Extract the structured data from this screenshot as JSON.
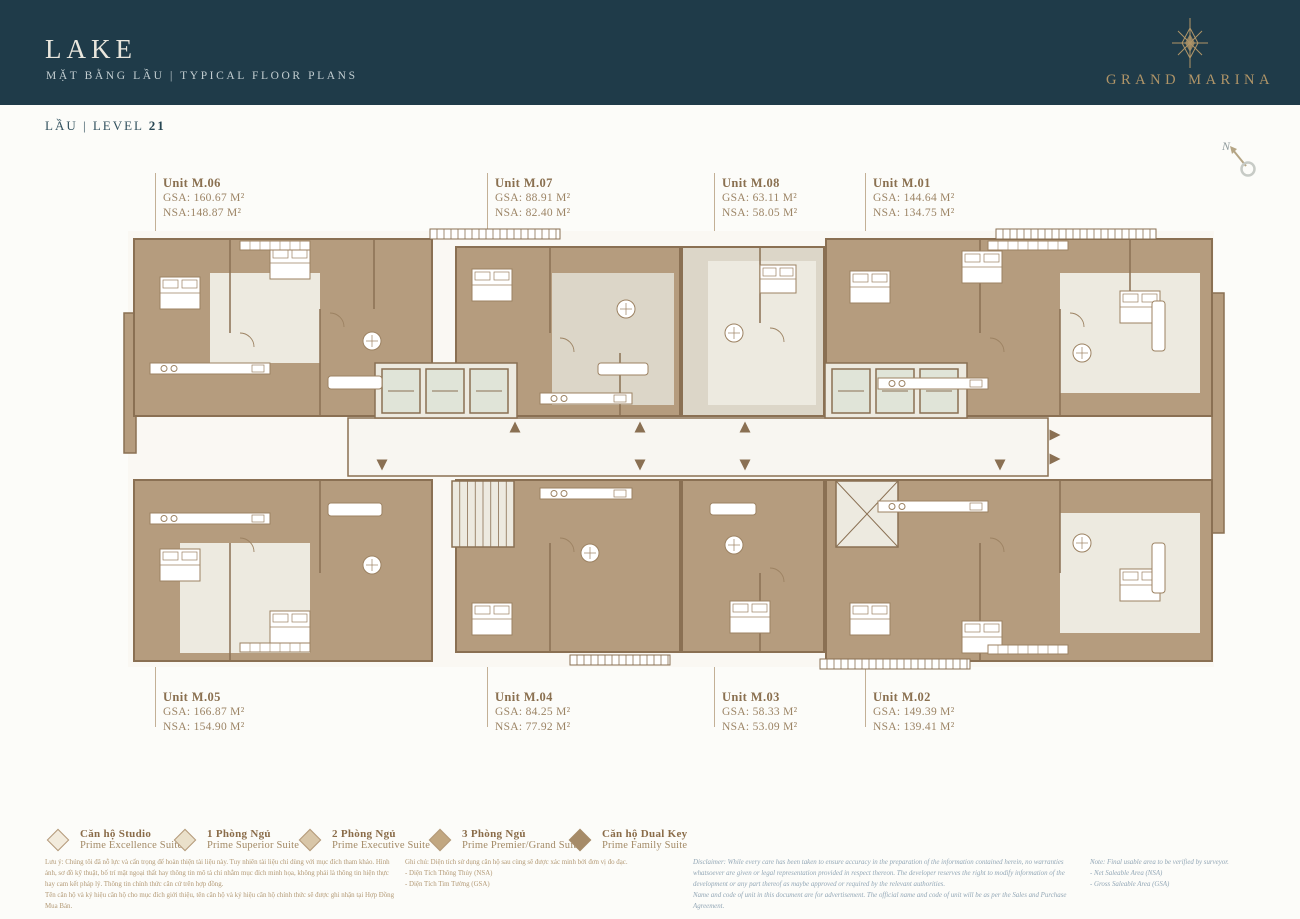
{
  "header": {
    "title": "LAKE",
    "subtitle": "MẶT BẰNG LẦU  |  TYPICAL FLOOR PLANS",
    "brand": "GRAND MARINA"
  },
  "level": {
    "label": "LẦU | LEVEL ",
    "number": "21"
  },
  "north_label": "N",
  "units": {
    "top": [
      {
        "name": "Unit M.06",
        "gsa": "GSA: 160.67 M²",
        "nsa": "NSA:148.87 M²"
      },
      {
        "name": "Unit M.07",
        "gsa": "GSA: 88.91 M²",
        "nsa": "NSA: 82.40 M²"
      },
      {
        "name": "Unit M.08",
        "gsa": "GSA: 63.11 M²",
        "nsa": "NSA: 58.05 M²"
      },
      {
        "name": "Unit M.01",
        "gsa": "GSA: 144.64 M²",
        "nsa": "NSA: 134.75 M²"
      }
    ],
    "bottom": [
      {
        "name": "Unit M.05",
        "gsa": "GSA: 166.87 M²",
        "nsa": "NSA: 154.90 M²"
      },
      {
        "name": "Unit M.04",
        "gsa": "GSA: 84.25 M²",
        "nsa": "NSA: 77.92 M²"
      },
      {
        "name": "Unit M.03",
        "gsa": "GSA: 58.33 M²",
        "nsa": "NSA: 53.09 M²"
      },
      {
        "name": "Unit M.02",
        "gsa": "GSA: 149.39 M²",
        "nsa": "NSA: 139.41 M²"
      }
    ]
  },
  "legend": [
    {
      "vi": "Căn hộ Studio",
      "en": "Prime Excellence Suite",
      "fill": "#f2ebdc",
      "border": "#b49a7a"
    },
    {
      "vi": "1 Phòng Ngủ",
      "en": "Prime Superior Suite",
      "fill": "#eae0ca",
      "border": "#b49a7a"
    },
    {
      "vi": "2 Phòng Ngủ",
      "en": "Prime Executive Suite",
      "fill": "#d8c6a8",
      "border": "#b49a7a"
    },
    {
      "vi": "3 Phòng Ngủ",
      "en": "Prime Premier/Grand Suite",
      "fill": "#c1a781",
      "border": "#b49a7a"
    },
    {
      "vi": "Căn hộ Dual Key",
      "en": "Prime Family Suite",
      "fill": "#a68b68",
      "border": "#a68b68"
    }
  ],
  "footnotes": {
    "vi_disclaimer": "Lưu ý: Chúng tôi đã nỗ lực và cẩn trọng để hoàn thiện tài liệu này. Tuy nhiên tài liệu chỉ dùng với mục đích tham khảo. Hình ảnh, sơ đồ kỹ thuật, bố trí mặt ngoại thất hay thông tin mô tả chỉ nhằm mục đích minh họa, không phải là thông tin hiện thực hay cam kết pháp lý. Thông tin chính thức căn cứ trên hợp đồng.\nTên căn hộ và ký hiệu căn hộ cho mục đích giới thiệu, tên căn hộ và ký hiệu căn hộ chính thức sẽ được ghi nhận tại Hợp Đồng Mua Bán.",
    "vi_notes": "Ghi chú: Diện tích sử dụng căn hộ sau cùng sẽ được xác minh bởi đơn vị đo đạc.\n- Diện Tích Thông Thủy (NSA)\n- Diện Tích Tim Tường (GSA)",
    "en_disclaimer": "Disclaimer: While every care has been taken to ensure accuracy in the preparation of the information contained herein, no warranties whatsoever are given or legal representation provided in respect thereon. The developer reserves the right to modify information of the development or any part thereof as maybe approved or required by the relevant authorities.\nName and code of unit in this document are for advertisement. The official name and code of unit will be as per the Sales and Purchase Agreement.",
    "en_notes": "Note: Final usable area to be verified by surveyor.\n- Net Saleable Area (NSA)\n- Gross Saleable Area (GSA)"
  },
  "colors": {
    "header_bg": "#1f3b49",
    "accent_gold": "#b09568",
    "plan_tan": "#b59c7e",
    "plan_wall": "#8a7053"
  }
}
